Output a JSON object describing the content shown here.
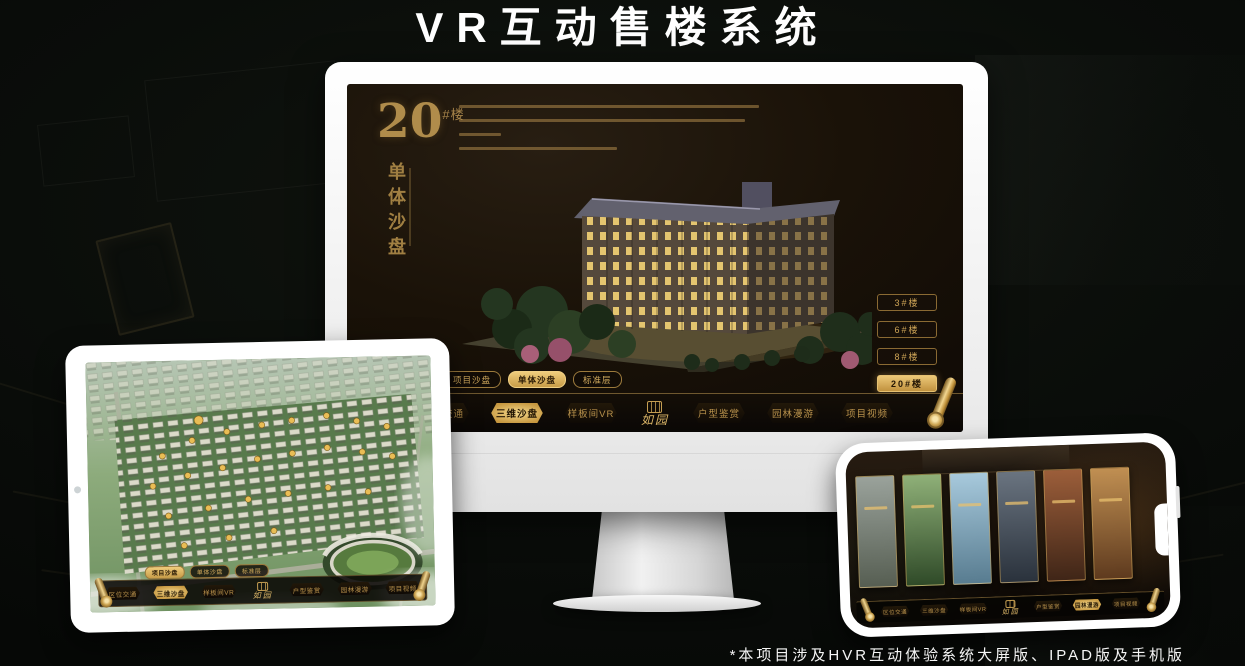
{
  "page": {
    "title": "VR互动售楼系统",
    "footnote": "*本项目涉及HVR互动体验系统大屏版、IPAD版及手机版"
  },
  "colors": {
    "gold": "#d2a955",
    "gold_bright": "#eecd7e",
    "screen_bg": "#171008",
    "device_white": "#f7f7f7"
  },
  "nav": {
    "logo": "如园",
    "items": [
      "区位交通",
      "三维沙盘",
      "样板间VR",
      "户型鉴赏",
      "园林漫游",
      "项目视频"
    ]
  },
  "sub_tabs": [
    "项目沙盘",
    "单体沙盘",
    "标准层"
  ],
  "monitor": {
    "heading_number": "20",
    "heading_suffix": "#楼",
    "heading_vertical": "单体沙盘",
    "active_sub_tab": "单体沙盘",
    "active_nav_item": "三维沙盘",
    "floor_buttons": [
      {
        "label": "3#楼",
        "active": false
      },
      {
        "label": "6#楼",
        "active": false
      },
      {
        "label": "8#楼",
        "active": false
      },
      {
        "label": "20#楼",
        "active": true
      }
    ]
  },
  "tablet": {
    "active_sub_tab": "项目沙盘",
    "active_nav_item": "三维沙盘"
  },
  "phone": {
    "active_nav_item": "园林漫游"
  }
}
